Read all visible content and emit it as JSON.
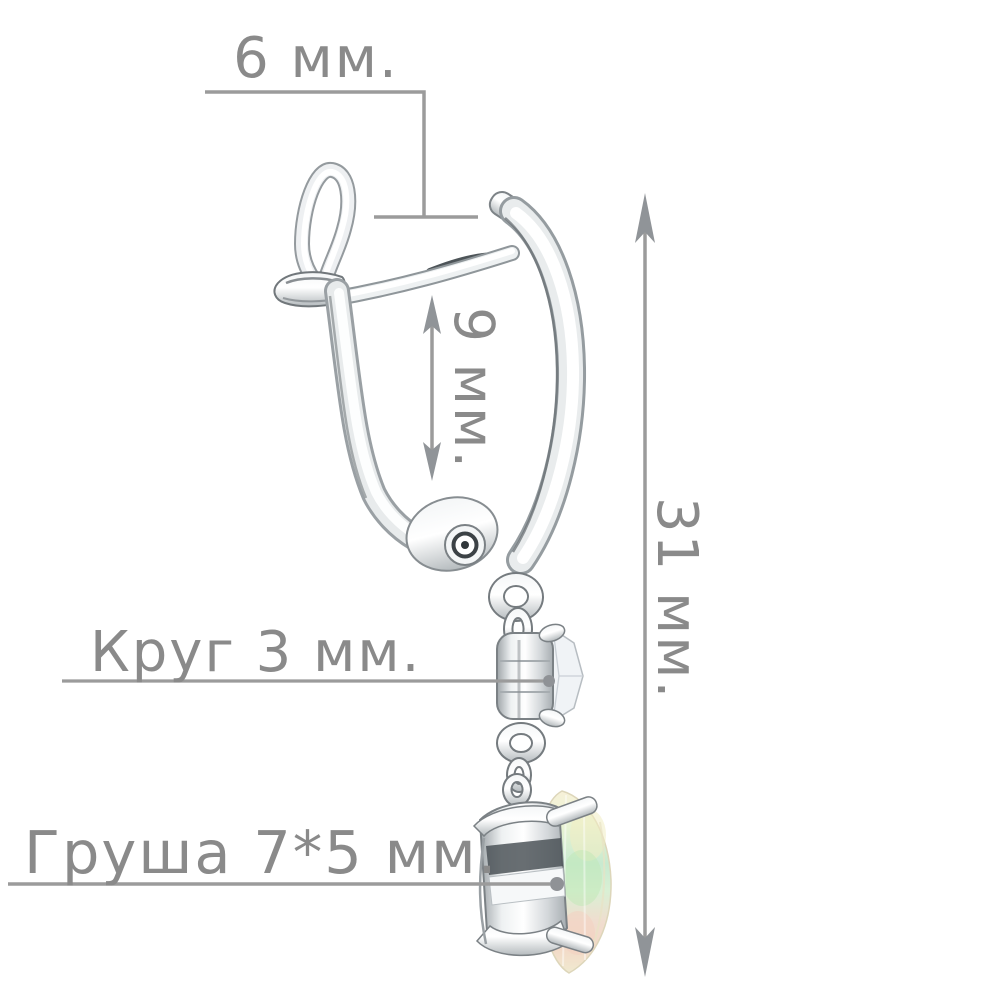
{
  "page": {
    "background": "#ffffff"
  },
  "diagram": {
    "type": "jewelry-dimension-diagram",
    "subject": "silver leverback drop earring with round stone and pear-shaped opal, side view",
    "annotations": {
      "hook_width": "6 мм.",
      "hoop_height": "9 мм.",
      "total_height": "31 мм.",
      "round_stone": "Круг 3 мм.",
      "pear_stone": "Груша 7*5 мм."
    },
    "colors": {
      "annotation_text": "#8a8a8a",
      "annotation_line": "#9b9b9b",
      "arrowhead": "#909498",
      "leader_dot": "#8f9296",
      "metal_highlight": "#ffffff",
      "metal_mid": "#d6dadc",
      "metal_dark": "#8d9296",
      "opal_yellow": "#f3eccd",
      "opal_green": "#c8e9c2",
      "opal_pink": "#f4d4c4"
    }
  }
}
